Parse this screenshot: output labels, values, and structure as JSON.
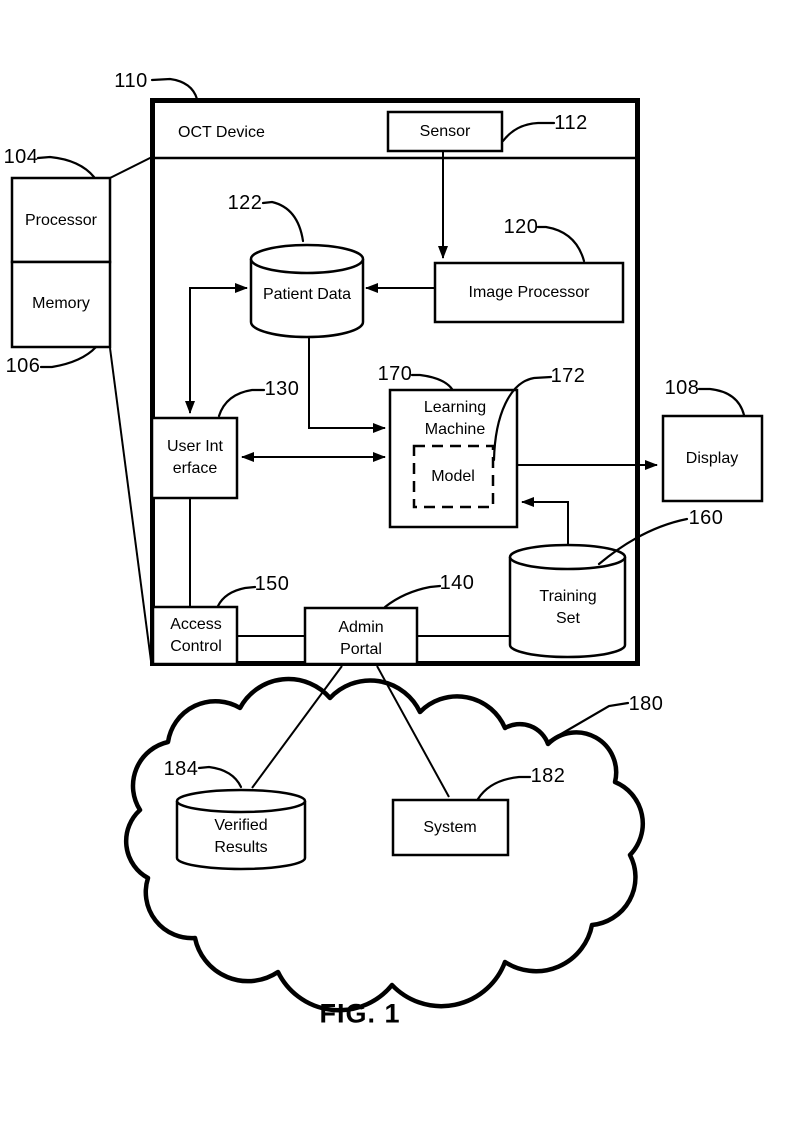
{
  "figure": {
    "caption": "FIG. 1"
  },
  "nodes": {
    "oct_device": {
      "label": "OCT Device",
      "ref": "110"
    },
    "sensor": {
      "label": "Sensor",
      "ref": "112"
    },
    "processor": {
      "label": "Processor",
      "ref": "104"
    },
    "memory": {
      "label": "Memory",
      "ref": "106"
    },
    "patient_data": {
      "label": "Patient Data",
      "ref": "122"
    },
    "image_processor": {
      "label": "Image Processor",
      "ref": "120"
    },
    "user_interface": {
      "label": "User Interface",
      "ref": "130"
    },
    "learning_machine": {
      "label": "Learning Machine",
      "ref": "170"
    },
    "model": {
      "label": "Model",
      "ref": "172"
    },
    "display": {
      "label": "Display",
      "ref": "108"
    },
    "training_set": {
      "label": "Training Set",
      "ref": "160"
    },
    "access_control": {
      "label": "Access Control",
      "ref": "150"
    },
    "admin_portal": {
      "label": "Admin Portal",
      "ref": "140"
    },
    "cloud": {
      "ref": "180"
    },
    "verified_results": {
      "label": "Verified Results",
      "ref": "184"
    },
    "system": {
      "label": "System",
      "ref": "182"
    }
  },
  "colors": {
    "line": "#000000",
    "background": "#ffffff"
  }
}
